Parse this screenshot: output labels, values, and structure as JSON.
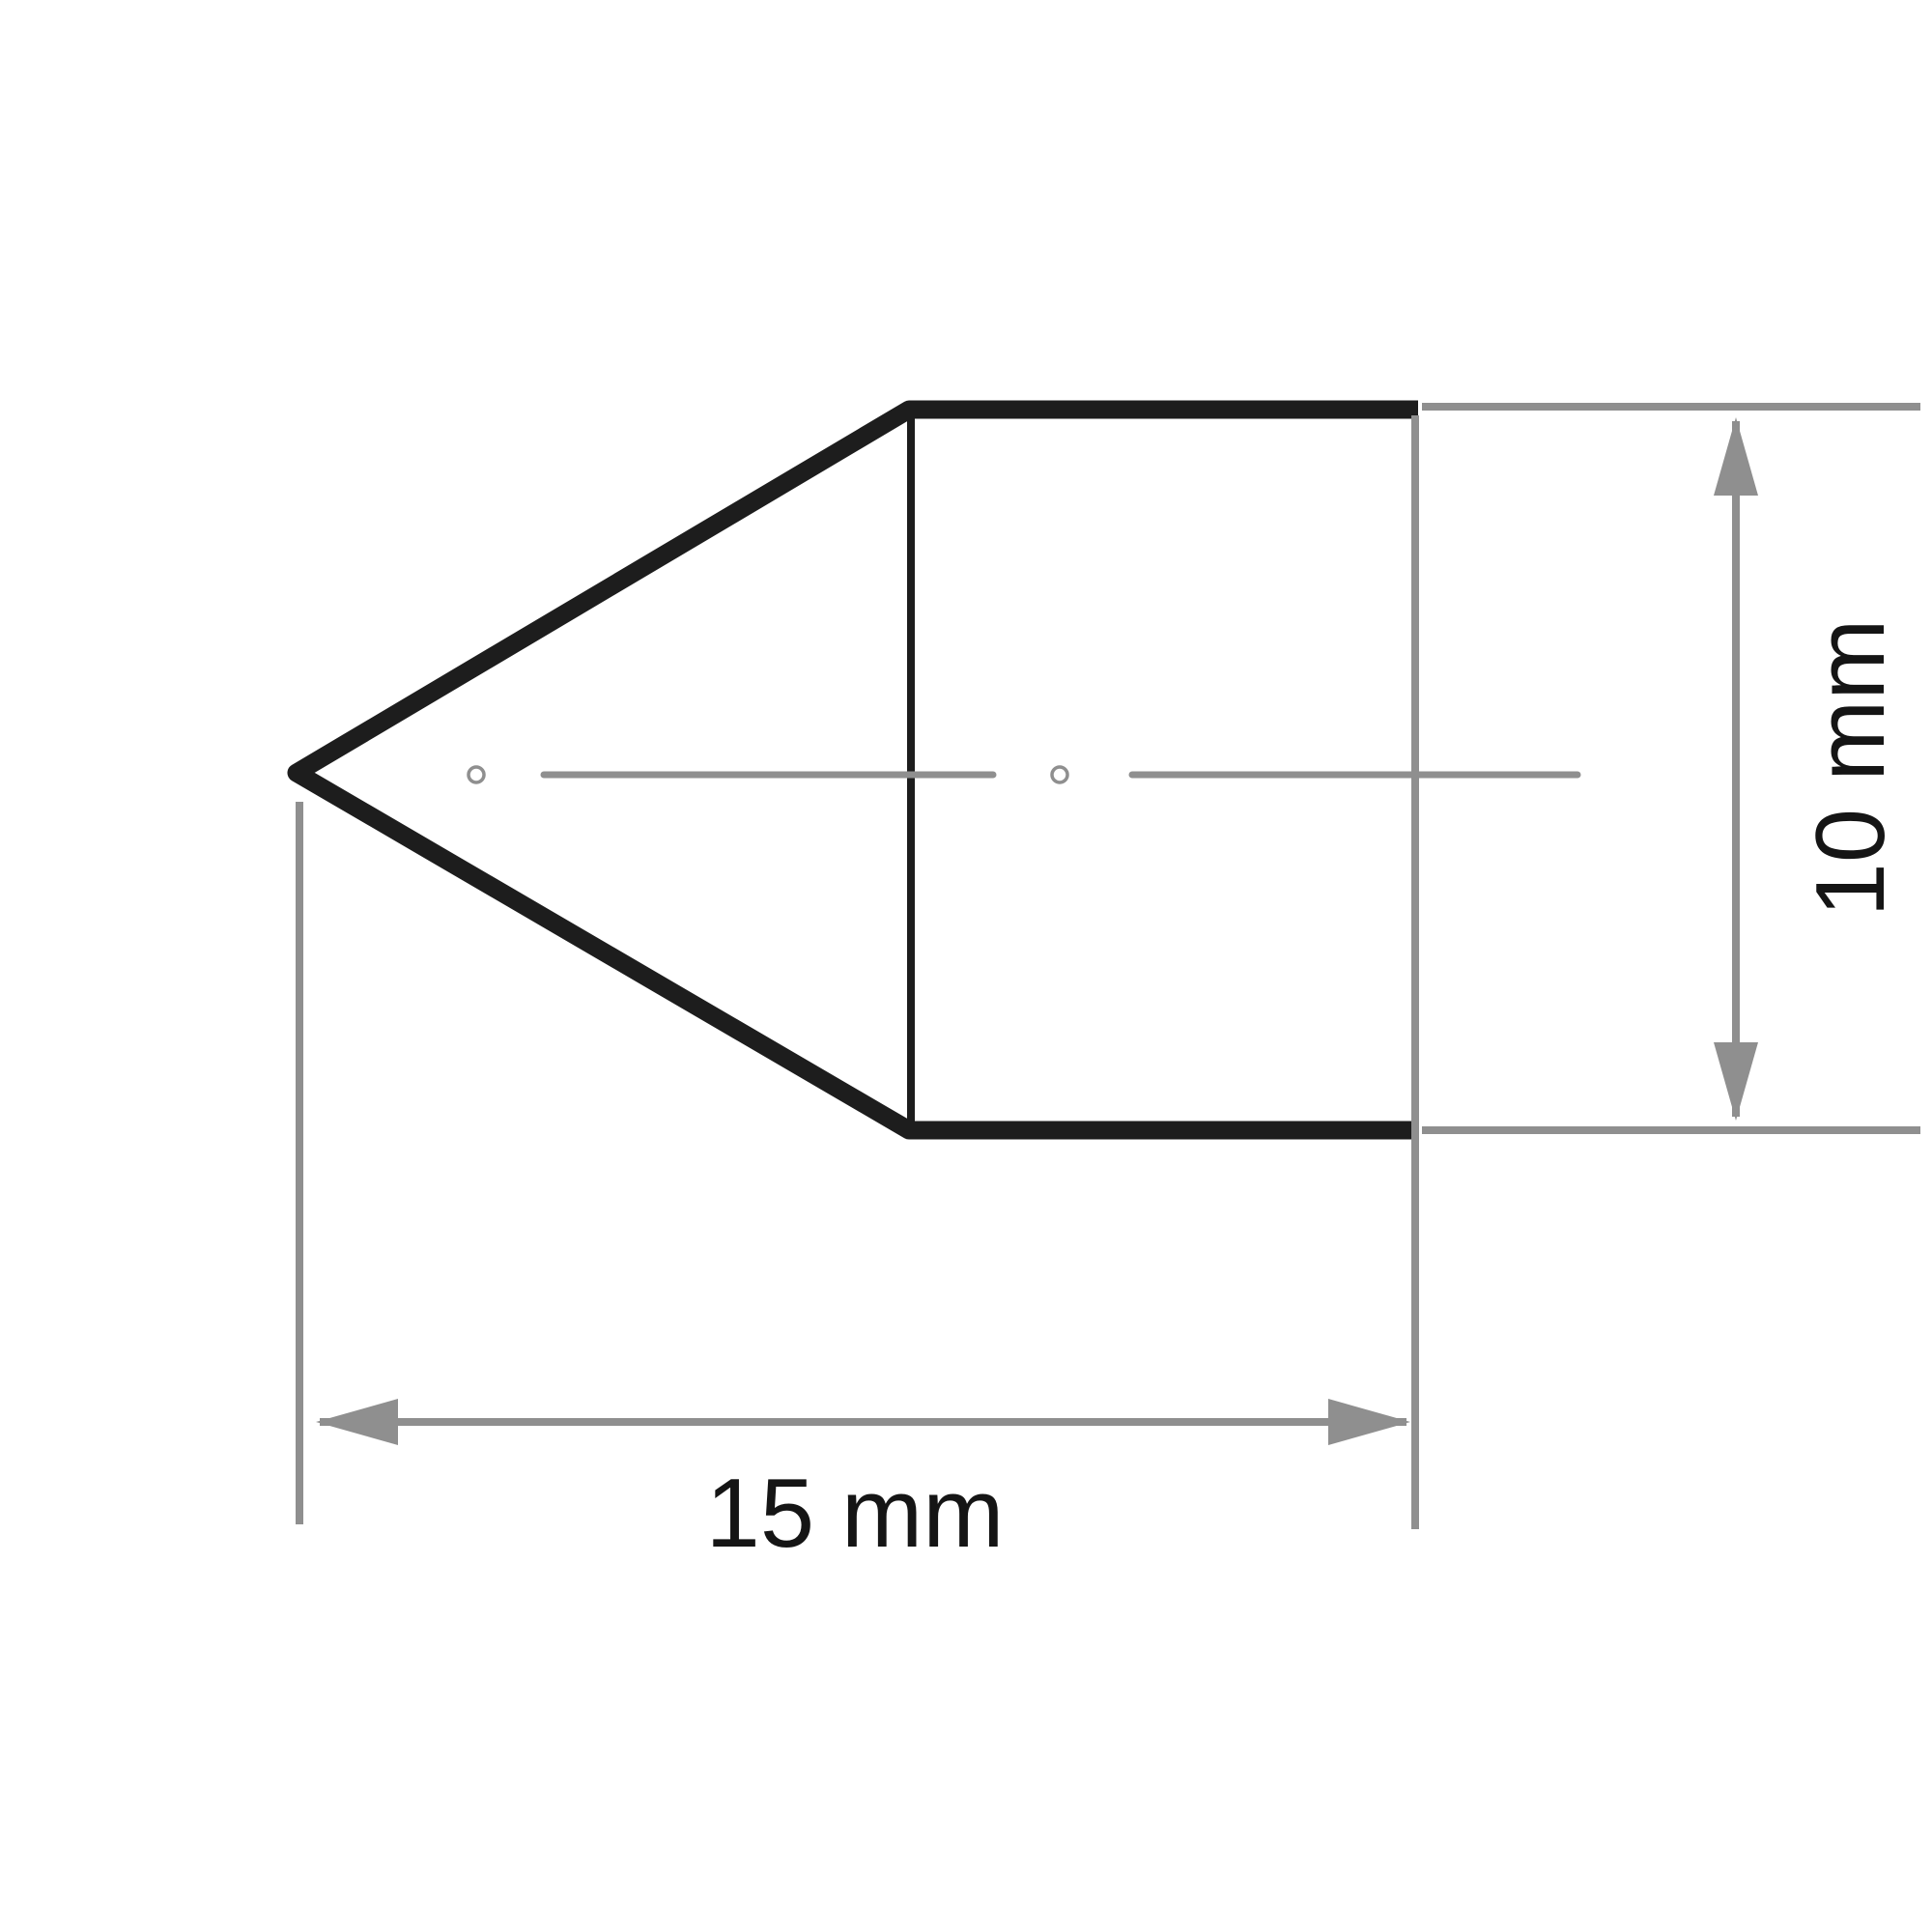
{
  "drawing": {
    "type": "technical-dimension-drawing",
    "labels": {
      "length": "15 mm",
      "diameter": "10 mm"
    },
    "values": {
      "length_mm": 15,
      "diameter_mm": 10
    },
    "colors": {
      "background": "#ffffff",
      "outline": "#1d1d1d",
      "dimension_gray": "#8f8f8f",
      "text": "#151515"
    }
  }
}
